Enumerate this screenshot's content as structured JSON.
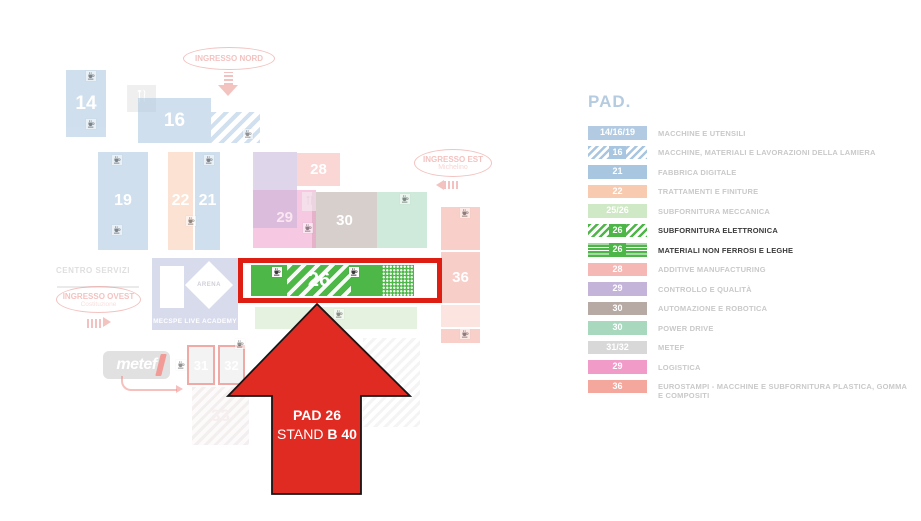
{
  "map": {
    "entrances": {
      "nord": {
        "label": "INGRESSO NORD"
      },
      "est": {
        "label": "INGRESSO EST",
        "sublabel": "Michelino"
      },
      "ovest": {
        "label": "INGRESSO OVEST",
        "sublabel": "Costituzione"
      }
    },
    "areas": {
      "centro_servizi": "CENTRO SERVIZI",
      "arena": "ARENA",
      "academy": "MECSPE LIVE ACADEMY",
      "metef": "metef"
    },
    "pavilions": {
      "p14": "14",
      "p16": "16",
      "p19": "19",
      "p21": "21",
      "p22": "22",
      "p26": "26",
      "p28": "28",
      "p29": "29",
      "p30": "30",
      "p31": "31",
      "p32": "32",
      "p33": "33",
      "p36": "36"
    },
    "callout": {
      "line1": "PAD 26",
      "line2_prefix": "STAND ",
      "line2_bold": "B 40"
    },
    "icons": {
      "amenity": "coffee-cup-icon",
      "restaurant": "fork-knife-icon"
    }
  },
  "legend": {
    "title": "PAD.",
    "items": [
      {
        "code": "14/16/19",
        "label": "MACCHINE E UTENSILI",
        "color": "#b3cbe2",
        "style": "solid",
        "highlight": false
      },
      {
        "code": "16",
        "label": "MACCHINE, MATERIALI E LAVORAZIONI DELLA LAMIERA",
        "color": "#a9c6e0",
        "style": "diag",
        "highlight": false
      },
      {
        "code": "21",
        "label": "FABBRICA DIGITALE",
        "color": "#a9c6e0",
        "style": "solid",
        "highlight": false
      },
      {
        "code": "22",
        "label": "TRATTAMENTI E FINITURE",
        "color": "#f8cbb0",
        "style": "solid",
        "highlight": false
      },
      {
        "code": "25/26",
        "label": "SUBFORNITURA MECCANICA",
        "color": "#cfe8c5",
        "style": "solid",
        "highlight": false
      },
      {
        "code": "26",
        "label": "SUBFORNITURA ELETTRONICA",
        "color": "#4eb648",
        "style": "diag",
        "highlight": true
      },
      {
        "code": "26",
        "label": "MATERIALI NON FERROSI E LEGHE",
        "color": "#4eb648",
        "style": "hlines",
        "highlight": true
      },
      {
        "code": "28",
        "label": "ADDITIVE MANUFACTURING",
        "color": "#f6b8b4",
        "style": "solid",
        "highlight": false
      },
      {
        "code": "29",
        "label": "CONTROLLO E QUALITÀ",
        "color": "#c5b4d9",
        "style": "solid",
        "highlight": false
      },
      {
        "code": "30",
        "label": "AUTOMAZIONE E ROBOTICA",
        "color": "#b7a9a4",
        "style": "solid",
        "highlight": false
      },
      {
        "code": "30",
        "label": "POWER DRIVE",
        "color": "#a8d8be",
        "style": "solid",
        "highlight": false
      },
      {
        "code": "31/32",
        "label": "METEF",
        "color": "#d8d8d8",
        "style": "solid",
        "highlight": false
      },
      {
        "code": "29",
        "label": "LOGISTICA",
        "color": "#f19bc9",
        "style": "solid",
        "highlight": false
      },
      {
        "code": "36",
        "label": "EUROSTAMPI - MACCHINE E SUBFORNITURA PLASTICA, GOMMA E COMPOSITI",
        "color": "#f4a79d",
        "style": "solid",
        "highlight": false
      }
    ]
  },
  "colors": {
    "highlight_green": "#4db748",
    "highlight_red_box": "#de1d13",
    "arrow_red": "#e02b23",
    "entrance_pink": "#e9918d",
    "legend_title_blue": "#b5cbdf"
  }
}
